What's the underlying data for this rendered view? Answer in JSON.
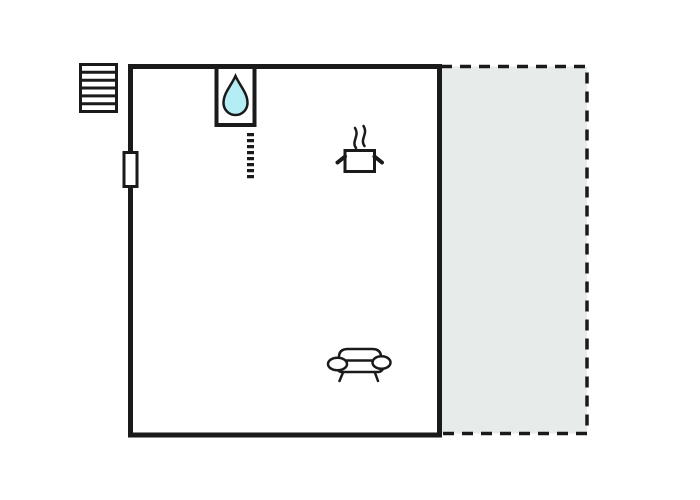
{
  "diagram": {
    "kind": "floor-plan",
    "colors": {
      "background": "#ffffff",
      "line": "#1a1a1a",
      "terrace_fill": "#e7ecea",
      "water_drop_fill": "#b5edf4",
      "fixture_fill": "#ffffff"
    },
    "areas": [
      {
        "name": "main-room",
        "outline": "solid-thick"
      },
      {
        "name": "terrace",
        "outline": "dashed"
      }
    ],
    "icons": [
      {
        "name": "stairs-icon",
        "meaning": "staircase"
      },
      {
        "name": "door-icon",
        "meaning": "door opening on left wall"
      },
      {
        "name": "water-drop-icon",
        "meaning": "sink / water fixture"
      },
      {
        "name": "cooking-pot-icon",
        "meaning": "kitchen / stove"
      },
      {
        "name": "sofa-icon",
        "meaning": "living area seating"
      },
      {
        "name": "dotted-divider-icon",
        "meaning": "dashed partition below sink"
      }
    ]
  }
}
